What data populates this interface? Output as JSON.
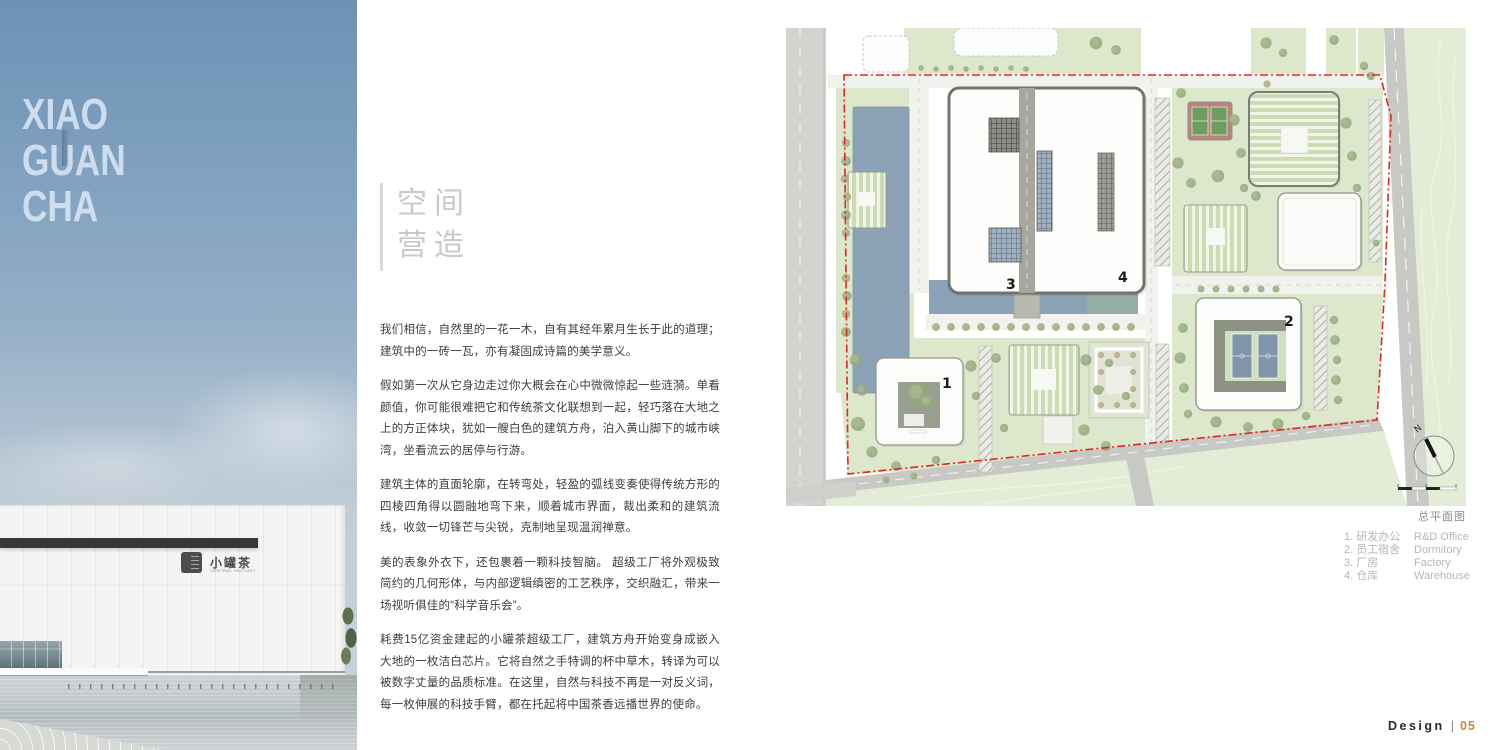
{
  "brand": {
    "lines": [
      "XIAO",
      "GUAN",
      "CHA"
    ]
  },
  "hero_sign": {
    "cn": "小罐茶",
    "en": "CENTRAL FACTORY"
  },
  "article": {
    "title_lines": [
      "空间",
      "营造"
    ],
    "paragraphs": [
      "我们相信，自然里的一花一木，自有其经年累月生长于此的道理；建筑中的一砖一瓦，亦有凝固成诗篇的美学意义。",
      "假如第一次从它身边走过你大概会在心中微微惊起一些涟漪。单看颜值，你可能很难把它和传统茶文化联想到一起，轻巧落在大地之上的方正体块，犹如一艘白色的建筑方舟，泊入黄山脚下的城市峡湾，坐看流云的居停与行游。",
      "建筑主体的直面轮廓，在转弯处，轻盈的弧线变奏使得传统方形的四棱四角得以圆融地弯下来，顺着城市界面，裁出柔和的建筑流线，收敛一切锋芒与尖锐，克制地呈现温润禅意。",
      "美的表象外衣下，还包裹着一颗科技智脑。 超级工厂将外观极致简约的几何形体，与内部逻辑缜密的工艺秩序，交织融汇，带来一场视听俱佳的“科学音乐会”。",
      "耗费15亿资金建起的小罐茶超级工厂，建筑方舟开始变身成嵌入大地的一枚洁白芯片。它将自然之手特调的杯中草木，转译为可以被数字丈量的品质标准。在这里，自然与科技不再是一对反义词，每一枚伸展的科技手臂，都在托起将中国茶香远播世界的使命。"
    ]
  },
  "plan": {
    "caption": "总平面图",
    "north_label": "N",
    "markers": [
      "1",
      "2",
      "3",
      "4"
    ],
    "legend": [
      {
        "cn": "1. 研发办公",
        "en": "R&D Office"
      },
      {
        "cn": "2. 员工宿舍",
        "en": "Dormitory"
      },
      {
        "cn": "3. 厂房",
        "en": "Factory"
      },
      {
        "cn": "4. 仓库",
        "en": "Warehouse"
      }
    ]
  },
  "footer": {
    "label": "Design",
    "separator": "|",
    "page_number": "05"
  },
  "colors": {
    "accent_orange": "#cd8540",
    "boundary_red": "#e0281e",
    "water_blue": "#8ba1b5"
  }
}
